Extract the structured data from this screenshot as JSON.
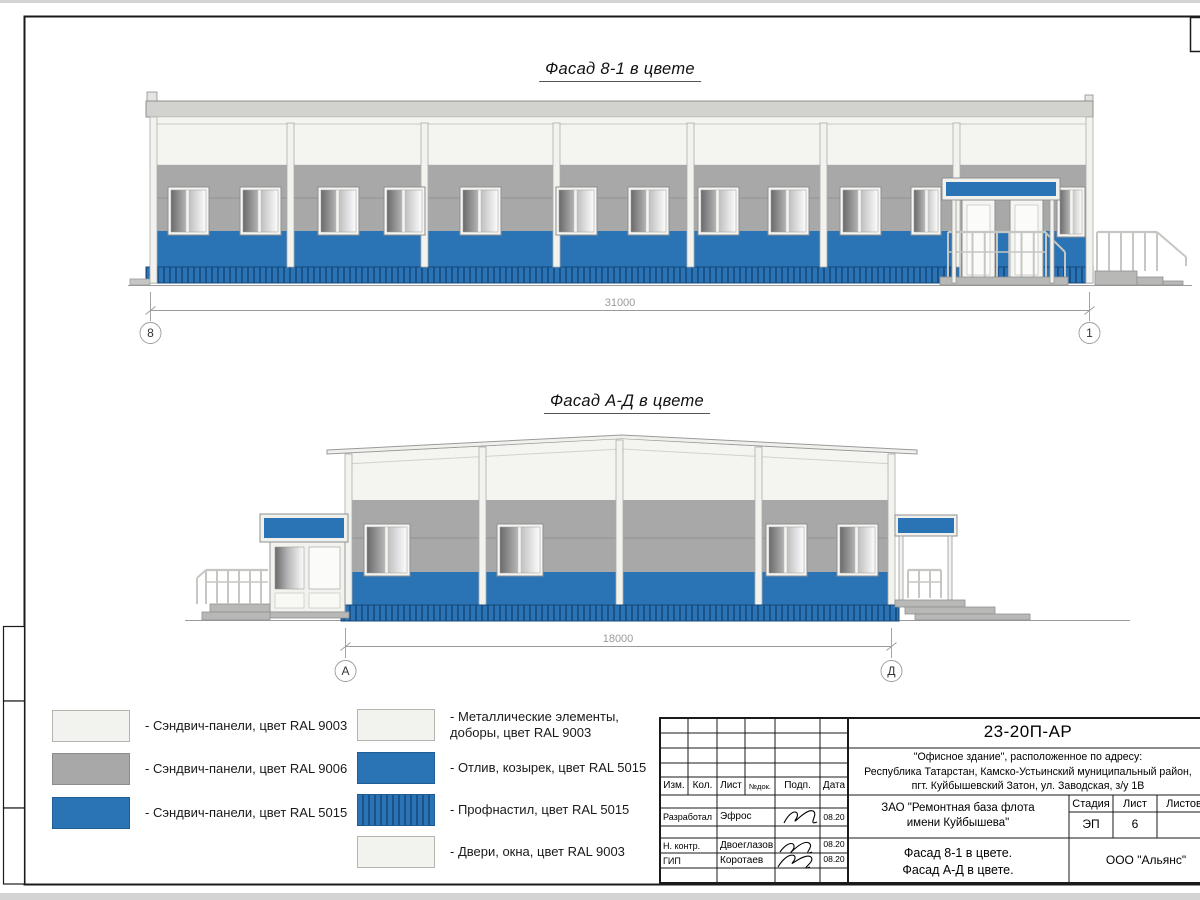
{
  "facades": {
    "facade1": {
      "title": "Фасад 8-1 в цвете",
      "dimension": "31000",
      "axis_left": "8",
      "axis_right": "1"
    },
    "facade2": {
      "title": "Фасад А-Д в цвете",
      "dimension": "18000",
      "axis_left": "А",
      "axis_right": "Д"
    }
  },
  "legend": {
    "left": [
      {
        "swatch": "panel-white",
        "label": "- Сэндвич-панели, цвет RAL 9003"
      },
      {
        "swatch": "panel-gray",
        "label": "- Сэндвич-панели, цвет RAL 9006"
      },
      {
        "swatch": "panel-blue",
        "label": "- Сэндвич-панели, цвет RAL 5015"
      }
    ],
    "right": [
      {
        "swatch": "panel-white",
        "label": "- Металлические элементы, доборы, цвет RAL 9003"
      },
      {
        "swatch": "panel-blue",
        "label": "- Отлив, козырек, цвет RAL 5015"
      },
      {
        "swatch": "panel-blue-striped",
        "label": "- Профнастил, цвет RAL 5015"
      },
      {
        "swatch": "panel-white",
        "label": "- Двери, окна, цвет RAL 9003"
      }
    ]
  },
  "colors": {
    "ral_9003_white": "#f2f2ee",
    "ral_9006_gray": "#a8a8a8",
    "ral_5015_blue": "#2a73b4",
    "plinth_stripe_dark": "#1a538a",
    "drawing_line_gray": "#9a9a9a"
  },
  "title_block": {
    "doc_number": "23-20П-АР",
    "object_lines": [
      "\"Офисное здание\", расположенное по адресу:",
      "Республика Татарстан, Камско-Устьинский муниципальный район,",
      "пгт. Куйбышевский Затон, ул. Заводская, з/у 1В"
    ],
    "client_lines": [
      "ЗАО \"Ремонтная база флота",
      "имени Куйбышева\""
    ],
    "sheet_title_lines": [
      "Фасад 8-1 в цвете.",
      "Фасад А-Д в цвете."
    ],
    "organization": "ООО \"Альянс\"",
    "columns": {
      "izm": "Изм.",
      "kol": "Кол.",
      "list": "Лист",
      "ndok": "№док.",
      "podp": "Подп.",
      "data": "Дата"
    },
    "stage": {
      "label": "Стадия",
      "value": "ЭП"
    },
    "sheet": {
      "label": "Лист",
      "value": "6"
    },
    "sheets": {
      "label": "Листов",
      "value": ""
    },
    "rows": [
      {
        "role": "Разработал",
        "name": "Эфрос",
        "date": "08.20"
      },
      {
        "role": "Н. контр.",
        "name": "Двоеглазов",
        "date": "08.20"
      },
      {
        "role": "ГИП",
        "name": "Коротаев",
        "date": "08.20"
      }
    ]
  }
}
